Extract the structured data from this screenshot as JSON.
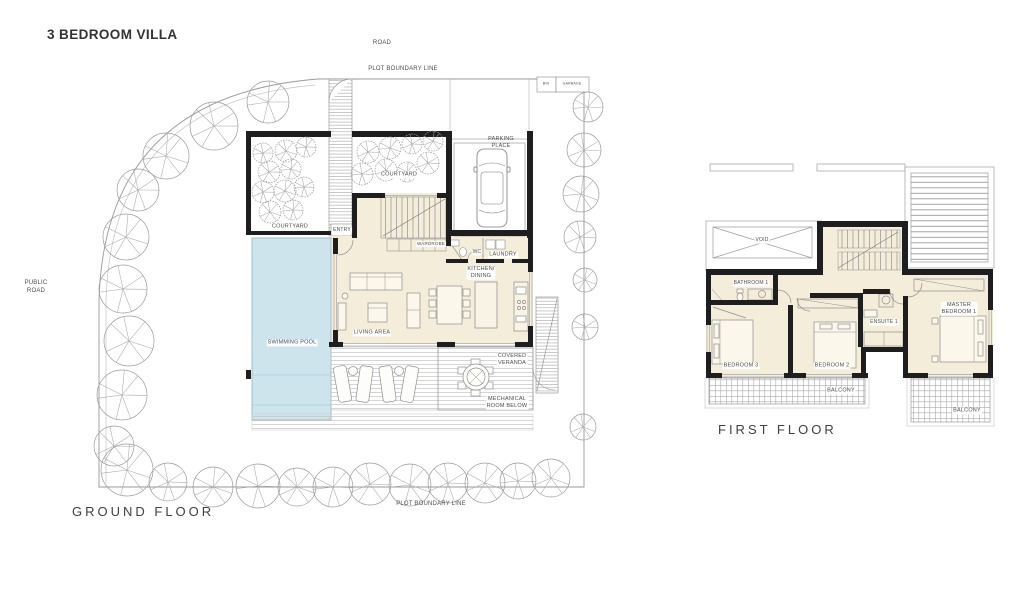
{
  "title": "3 BEDROOM VILLA",
  "colors": {
    "floor_fill": "#f4edda",
    "pool_fill": "#cde4ed",
    "wall": "#1e1e1e",
    "line_gray": "#8c8c8c",
    "label": "#4d4d4d"
  },
  "site": {
    "road": "ROAD",
    "public_road": "PUBLIC\nROAD",
    "plot_boundary": "PLOT BOUNDARY LINE",
    "bin": "BIN",
    "garbage": "GARBAGE"
  },
  "ground_floor": {
    "title": "GROUND FLOOR",
    "rooms": {
      "parking": "PARKING\nPLACE",
      "courtyard_right": "COURTYARD",
      "courtyard_left": "COURTYARD",
      "entry": "ENTRY",
      "wardrobe": "WARDROBE",
      "wc": "WC",
      "laundry": "LAUNDRY",
      "kitchen_dining": "KITCHEN/\nDINING",
      "living_area": "LIVING AREA",
      "swimming_pool": "SWIMMING POOL",
      "covered_veranda": "COVERED\nVERANDA",
      "mechanical_room": "MECHANICAL\nROOM BELOW"
    }
  },
  "first_floor": {
    "title": "FIRST FLOOR",
    "rooms": {
      "void": "VOID",
      "bathroom_1": "BATHROOM 1",
      "bedroom_3": "BEDROOM 3",
      "bedroom_2": "BEDROOM 2",
      "ensuite_1": "ENSUITE 1",
      "master_bedroom_1": "MASTER\nBEDROOM 1",
      "balcony_center": "BALCONY",
      "balcony_right": "BALCONY"
    }
  }
}
